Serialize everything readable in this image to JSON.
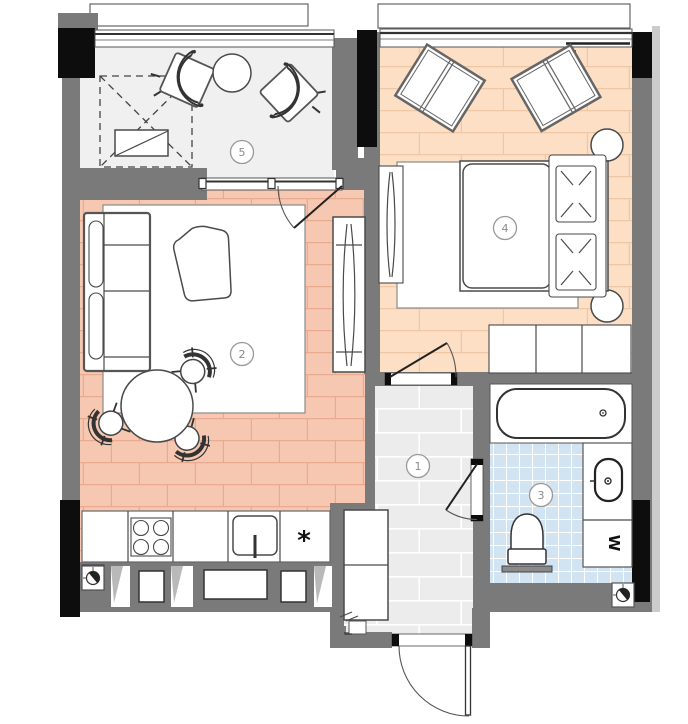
{
  "title": "apartment-floor-plan",
  "rooms": {
    "hallway": {
      "number": "1"
    },
    "living": {
      "number": "2"
    },
    "bathroom": {
      "number": "3"
    },
    "bedroom": {
      "number": "4"
    },
    "balcony": {
      "number": "5"
    }
  },
  "labels": {
    "washer": "W",
    "kitchen_star": "*"
  },
  "icons": [
    "vent-symbol",
    "stove-burners",
    "sink-tap",
    "toilet",
    "bathtub",
    "washbasin"
  ],
  "colors": {
    "wall": "#7a7a7a",
    "blk": "#0d0d0d",
    "outer": "#cccccc",
    "living": "#f7c8b1",
    "living_line": "#e9aa90",
    "bedroom": "#fcdfc5",
    "bedroom_line": "#efc7a5",
    "balcony": "#f0f0f0",
    "hall": "#ececec",
    "hall_line": "#ffffff",
    "bath": "#d2e3f2",
    "bath_line": "#ffffff",
    "furn_stroke": "#4a4a4a",
    "rug": "#ffffff",
    "label": "#8a8a8a"
  }
}
